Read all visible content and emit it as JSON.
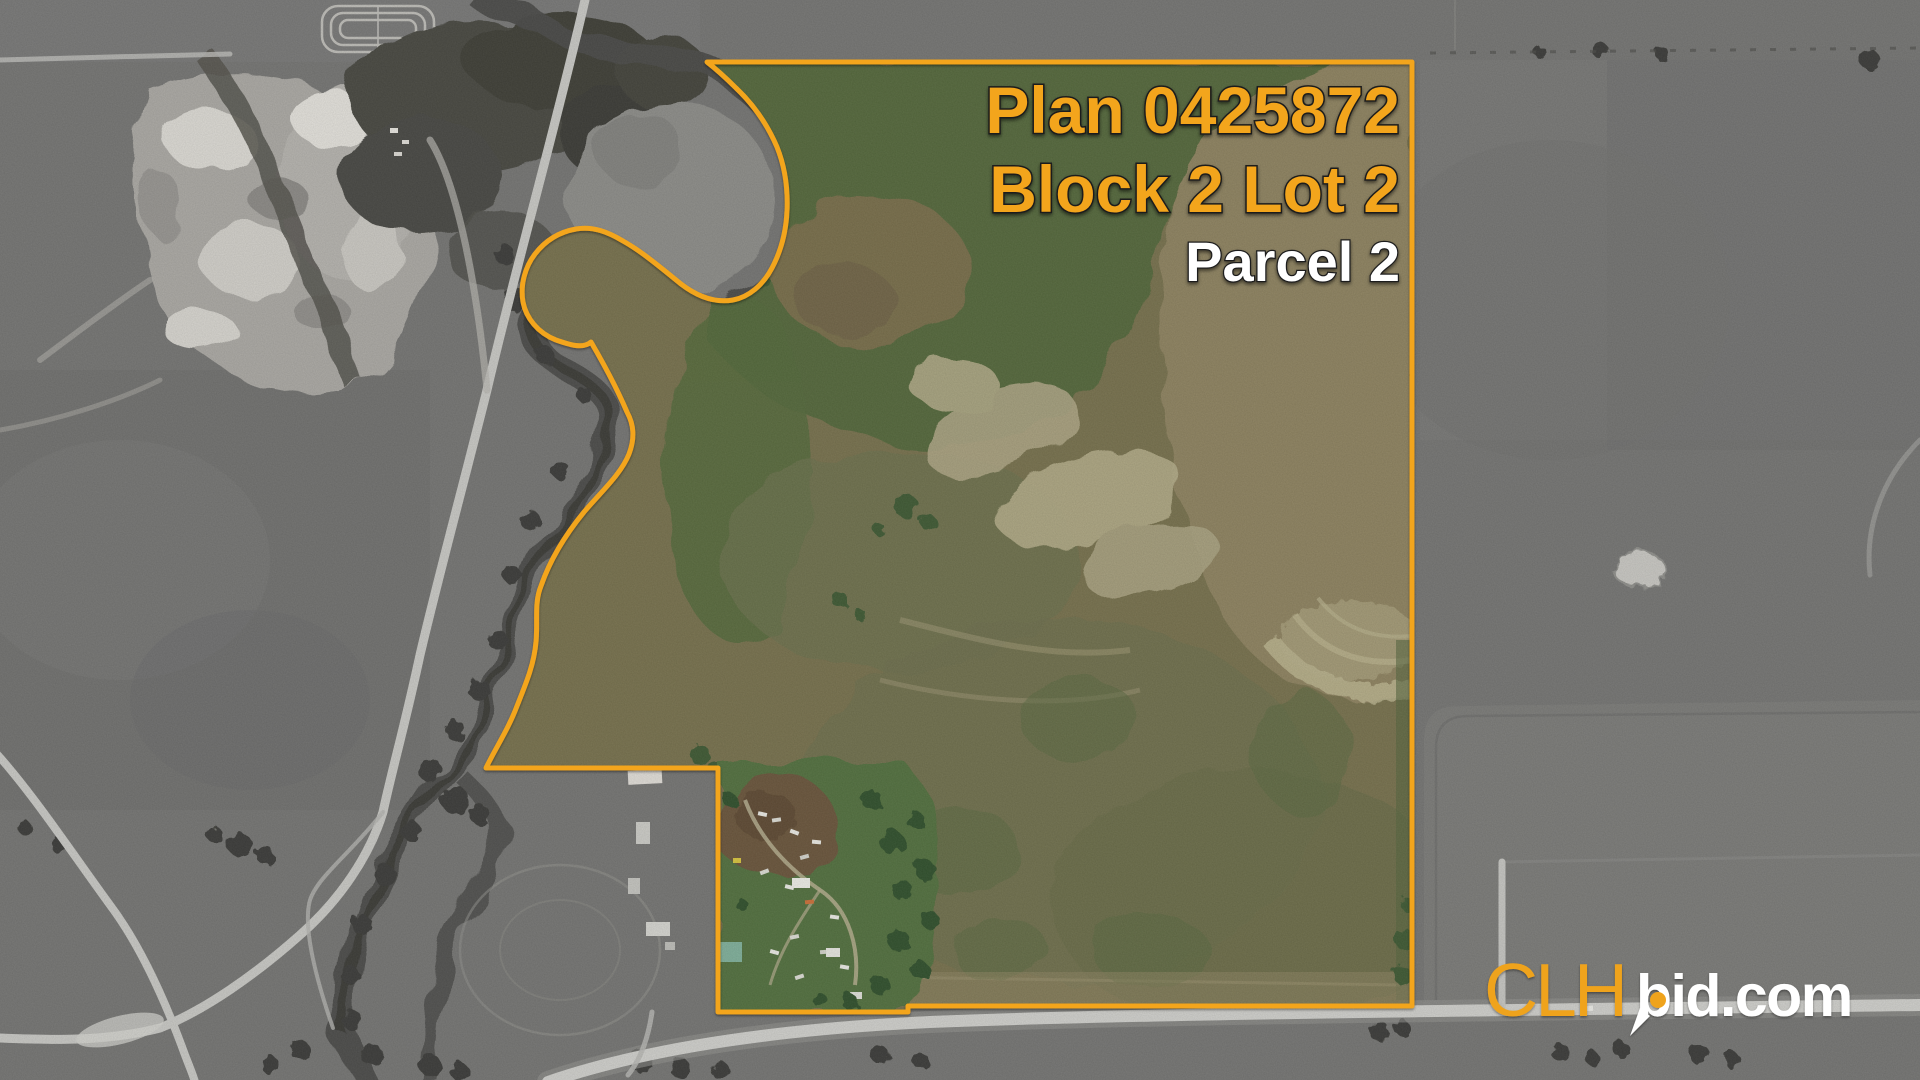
{
  "overlay": {
    "plan_line": "Plan 0425872",
    "block_line": "Block 2 Lot 2",
    "parcel_line": "Parcel 2"
  },
  "logo": {
    "clh": "CLH",
    "bid": "bid.com"
  },
  "colors": {
    "boundary_orange": "#F3A51E",
    "label_orange": "#F3A51E",
    "label_white": "#FFFFFF",
    "logo_orange": "#EFA31F",
    "logo_white": "#FFFFFF"
  },
  "map": {
    "kind": "aerial-satellite-photo",
    "parcel_area_rendering": "full colour inside boundary",
    "surroundings_rendering": "grayscale outside boundary"
  }
}
